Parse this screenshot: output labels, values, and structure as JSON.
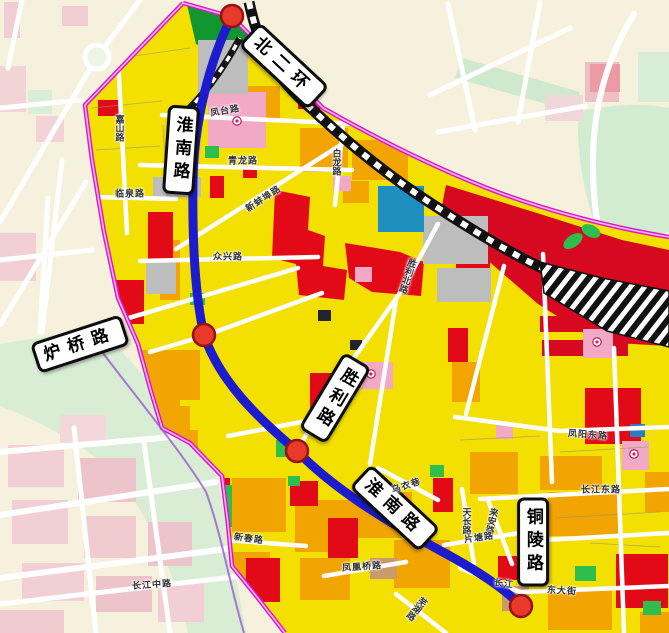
{
  "map": {
    "description": "urban zoning map with planning boundary, transit route and road signs",
    "palette": {
      "area_fill": "#f3df00",
      "orange_parcel": "#f2a400",
      "red_parcel": "#e30a18",
      "crimson_parcel": "#d60920",
      "pink_parcel": "#f2a9c6",
      "green_parcel": "#2dbe4e",
      "dark_green_parcel": "#12962f",
      "gray_parcel": "#bdbdbd",
      "blue_parcel": "#1f8fc0",
      "tan_parcel": "#c89a6e",
      "boundary": "#da18ca",
      "route": "#1c1cce",
      "station_fill": "#e8392b",
      "station_stroke": "#951212",
      "road": "#ffffff",
      "railway": "#111111",
      "outside_bg": "#f6f1dc",
      "outside_green": "#d8edd3",
      "outside_pink": "#f3d3d6"
    },
    "major_labels": [
      {
        "text": "北二环",
        "x": 284,
        "y": 66,
        "rot": 43,
        "vertical": false
      },
      {
        "text": "淮南路",
        "x": 181,
        "y": 150,
        "rot": 4,
        "vertical": true
      },
      {
        "text": "炉桥路",
        "x": 80,
        "y": 344,
        "rot": -18,
        "vertical": false
      },
      {
        "text": "胜利路",
        "x": 335,
        "y": 398,
        "rot": 31,
        "vertical": true
      },
      {
        "text": "淮南路",
        "x": 395,
        "y": 508,
        "rot": 43,
        "vertical": false
      },
      {
        "text": "铜陵路",
        "x": 533,
        "y": 542,
        "rot": 0,
        "vertical": true
      }
    ],
    "minor_labels": [
      {
        "text": "凤台路",
        "x": 225,
        "y": 110,
        "rot": -10,
        "vertical": false
      },
      {
        "text": "青龙路",
        "x": 243,
        "y": 160,
        "rot": 0,
        "vertical": false
      },
      {
        "text": "白龙路",
        "x": 337,
        "y": 162,
        "rot": 0,
        "vertical": true
      },
      {
        "text": "嘉山路",
        "x": 120,
        "y": 128,
        "rot": 0,
        "vertical": true
      },
      {
        "text": "临泉路",
        "x": 130,
        "y": 193,
        "rot": 0,
        "vertical": false
      },
      {
        "text": "新蚌埠路",
        "x": 263,
        "y": 198,
        "rot": -33,
        "vertical": false
      },
      {
        "text": "众兴路",
        "x": 228,
        "y": 256,
        "rot": 0,
        "vertical": false
      },
      {
        "text": "胜利北路",
        "x": 408,
        "y": 276,
        "rot": 18,
        "vertical": true
      },
      {
        "text": "凤阳东路",
        "x": 588,
        "y": 434,
        "rot": 4,
        "vertical": false
      },
      {
        "text": "长江东路",
        "x": 601,
        "y": 489,
        "rot": 0,
        "vertical": false
      },
      {
        "text": "乌衣巷",
        "x": 406,
        "y": 485,
        "rot": -18,
        "vertical": false
      },
      {
        "text": "天长路",
        "x": 467,
        "y": 521,
        "rot": 0,
        "vertical": true
      },
      {
        "text": "来安路",
        "x": 492,
        "y": 521,
        "rot": 12,
        "vertical": true
      },
      {
        "text": "片塘路",
        "x": 479,
        "y": 537,
        "rot": -8,
        "vertical": false
      },
      {
        "text": "长江",
        "x": 504,
        "y": 583,
        "rot": 8,
        "vertical": false
      },
      {
        "text": "东大街",
        "x": 562,
        "y": 590,
        "rot": 4,
        "vertical": false
      },
      {
        "text": "凤凰桥路",
        "x": 362,
        "y": 566,
        "rot": -4,
        "vertical": false
      },
      {
        "text": "芜湖路",
        "x": 417,
        "y": 609,
        "rot": 38,
        "vertical": true
      },
      {
        "text": "新春路",
        "x": 249,
        "y": 538,
        "rot": 8,
        "vertical": false
      },
      {
        "text": "长江中路",
        "x": 152,
        "y": 584,
        "rot": -4,
        "vertical": false
      }
    ],
    "stations": [
      {
        "x": 232,
        "y": 16
      },
      {
        "x": 204,
        "y": 335
      },
      {
        "x": 297,
        "y": 451
      },
      {
        "x": 521,
        "y": 606
      }
    ]
  }
}
